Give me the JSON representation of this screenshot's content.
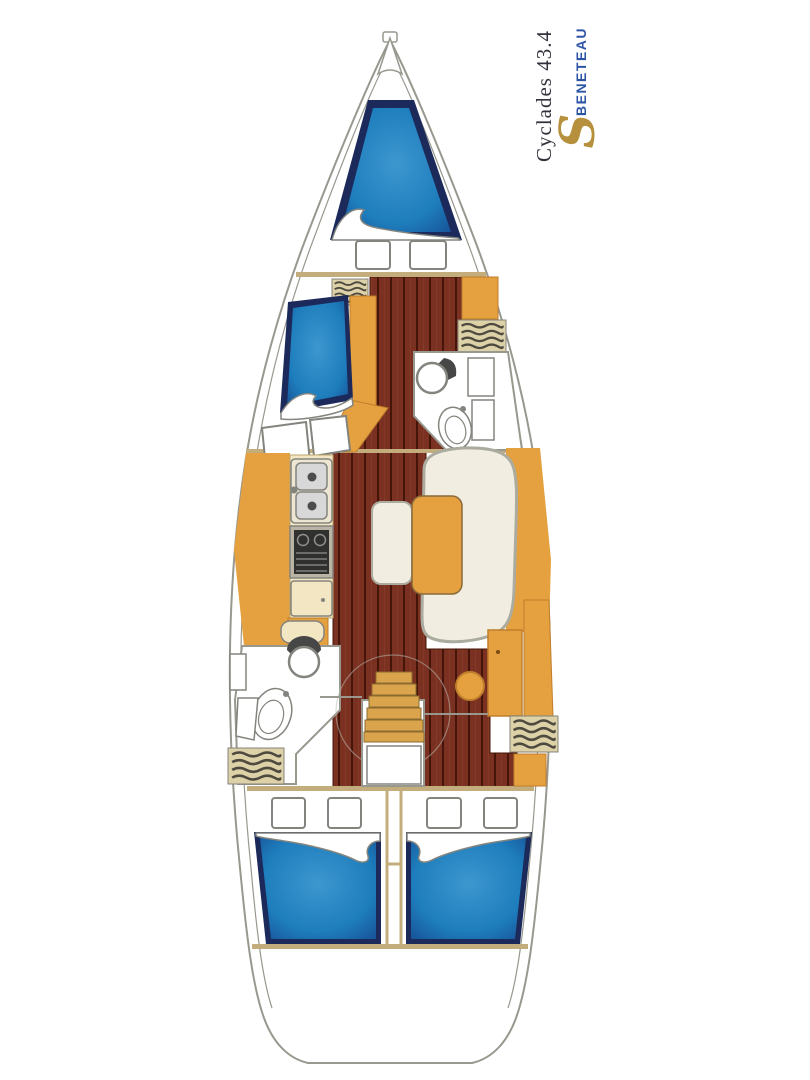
{
  "header": {
    "model": "Cyclades 43.4",
    "brand": "BENETEAU",
    "logo_glyph": "S"
  },
  "colors": {
    "background": "#ffffff",
    "title_color": "#32323c",
    "brand_blue": "#2d55a5",
    "logo_gold": "#b6903c",
    "hull_stroke": "#98988f",
    "bulkhead_tan": "#c3ad7c",
    "bed_navy": "#1b2a5a",
    "bed_blue": "#1e7dbc",
    "bed_blue_light": "#3d97cf",
    "bed_blue_deep": "#15498f",
    "wood_base": "#7a3121",
    "wood_seam": "#45150a",
    "wood_light": "#9a4a2e",
    "orange": "#e5a03f",
    "orange_stroke": "#bf7e2b",
    "step_tan": "#d9a44c",
    "cream": "#f3e7c3",
    "locker_tan": "#ddd1a8",
    "hatch_stroke": "#4e4a40",
    "settee_cream": "#f1ede0",
    "trim_gray": "#abab9f",
    "fixture_stroke": "#84847e",
    "dark_fixture": "#474747",
    "stove_dark": "#30302e",
    "metal": "#d8d8d8"
  }
}
